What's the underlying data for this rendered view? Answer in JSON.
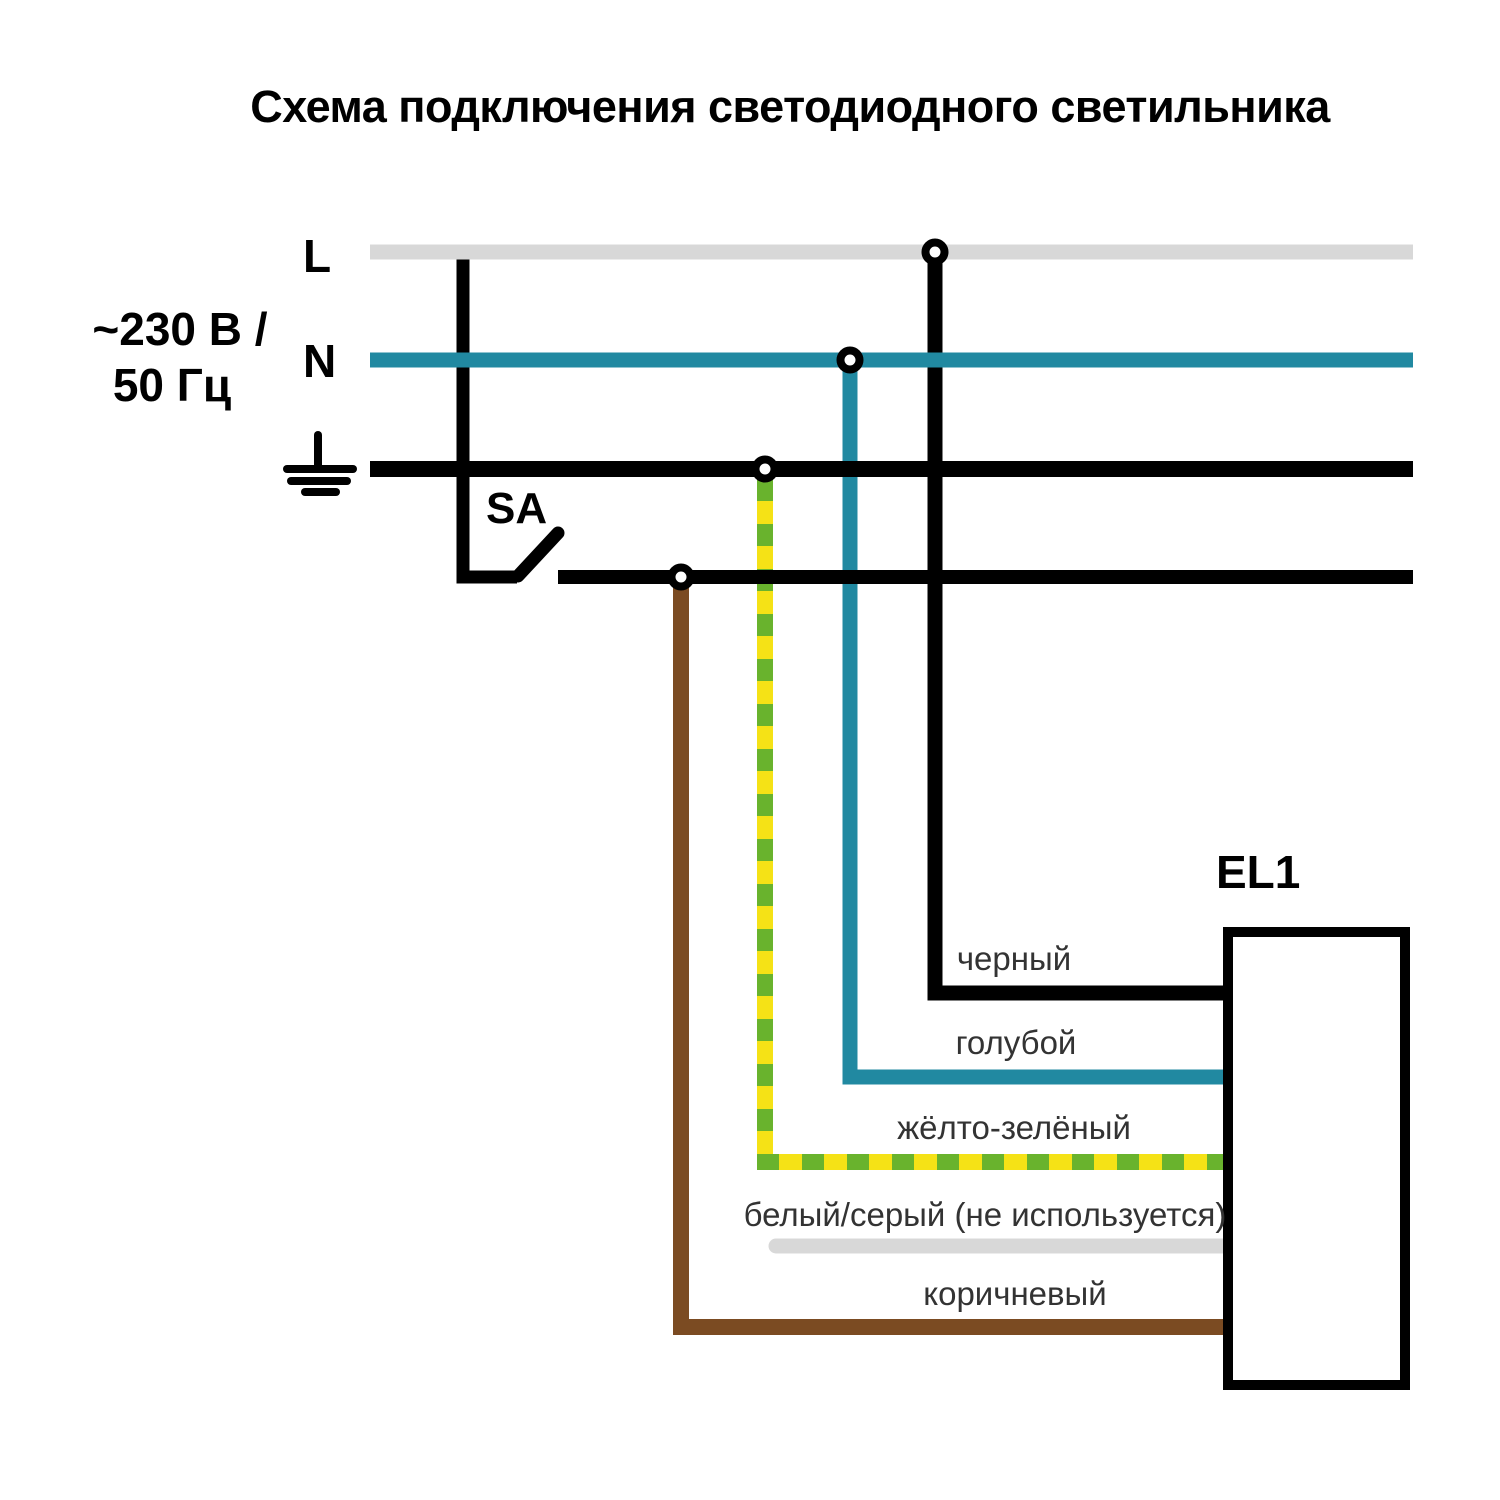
{
  "title": "Схема подключения светодиодного светильника",
  "source": {
    "voltage_line1": "~230 В /",
    "voltage_line2": "50 Гц",
    "phase_label": "L",
    "neutral_label": "N"
  },
  "switch_label": "SA",
  "luminaire_label": "EL1",
  "bus_colors": {
    "l_line": "#D8D8D8",
    "n_line": "#2189A1",
    "pe_line": "#000000",
    "switched_line": "#000000"
  },
  "wires": {
    "black": {
      "label": "черный",
      "color": "#000000"
    },
    "blue": {
      "label": "голубой",
      "color": "#2189A1"
    },
    "yellow_green": {
      "label": "жёлто-зелёный",
      "yellow": "#F5E216",
      "green": "#69B32D"
    },
    "white_gray": {
      "label": "белый/серый (не используется)",
      "color": "#D8D8D8"
    },
    "brown": {
      "label": "коричневый",
      "color": "#7B4B22"
    }
  }
}
